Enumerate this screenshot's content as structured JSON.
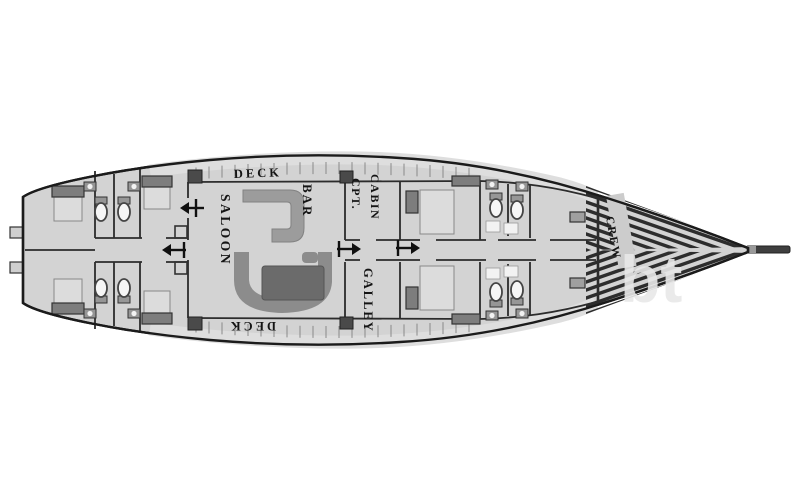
{
  "diagram": {
    "type": "yacht-deck-plan",
    "labels": {
      "deck_top": "DECK",
      "deck_bottom": "DECK",
      "saloon": "SALOON",
      "bar": "BAR",
      "cpt_cabin_line1": "CPT.",
      "cpt_cabin_line2": "CABIN",
      "galley": "GALLEY",
      "crew": "CREW"
    },
    "watermark": "bt",
    "icons": {
      "companionway_arrow": "direction-arrow",
      "toilet": "toilet-fixture",
      "sink": "sink-fixture",
      "bed": "berth-bed",
      "bowsprit": "bowsprit-pole"
    },
    "colors": {
      "hull_fill": "#d3d3d3",
      "hull_outline": "#1b1b1b",
      "wall": "#2c2c2c",
      "band_fill": "#dedede",
      "band_line": "#777777",
      "plank_stripe": "#2d2d2d",
      "tick": "#8a8a8a",
      "sofa": "#8c8c8c",
      "table": "#6b6b6b",
      "bar": "#9c9c9c",
      "bed_dark": "#7d7d7d",
      "mattress": "#dcdcdc",
      "fixture": "#969696",
      "square": "#4a4a4a",
      "crew_band": "#cccccc",
      "wm": "#e8e8e8"
    }
  }
}
